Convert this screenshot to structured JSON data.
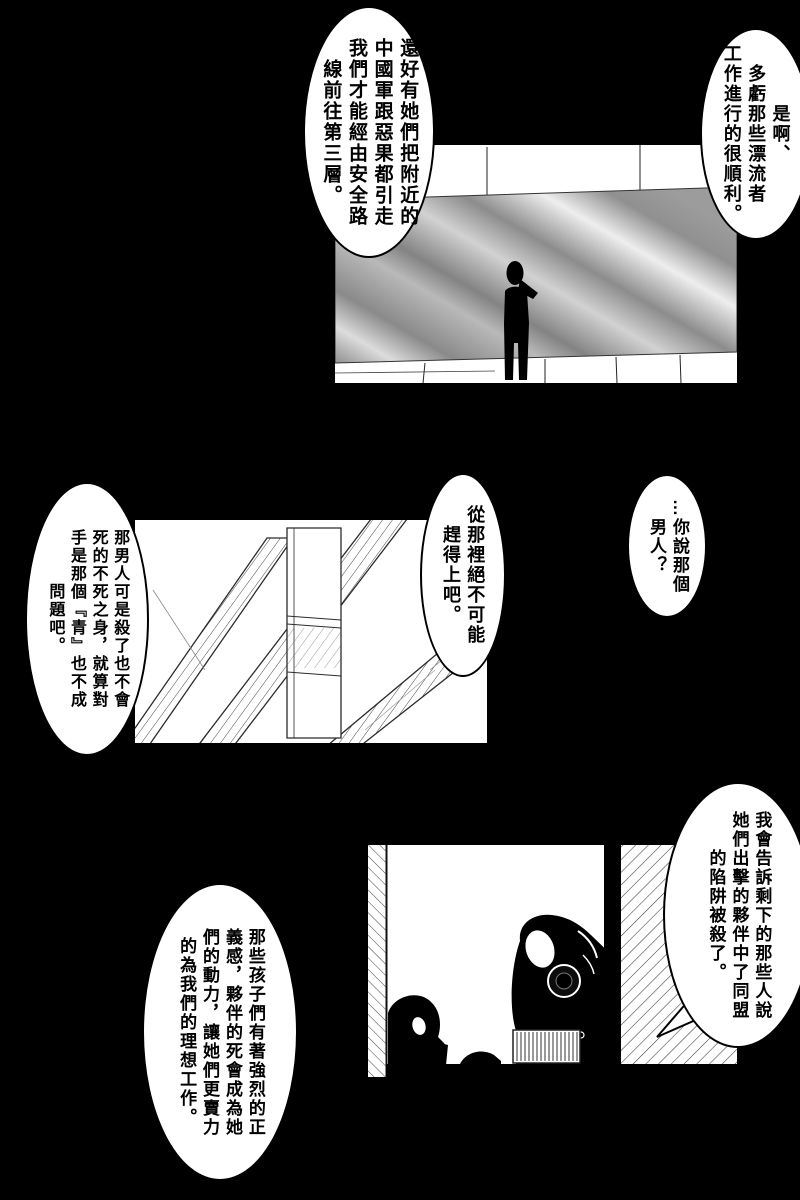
{
  "page": {
    "background_color": "#000000",
    "panel_color": "#ffffff",
    "ink_color": "#000000",
    "wall_gray": "#8f8f8f",
    "wall_highlight": "#ededed"
  },
  "bubbles": {
    "top_right": {
      "text": "是啊、\n多虧那些漂流者\n工作進行的很順利。"
    },
    "top_left": {
      "text": "還好有她們把附近的\n中國軍跟惡果都引走\n我們才能經由安全路\n線前往第三層。"
    },
    "mid_left": {
      "text": "那男人可是殺了也不會\n死的不死之身，就算對\n手是那個『青』也不成\n問題吧。"
    },
    "mid_center": {
      "text": "從那裡絕不可能\n趕得上吧。"
    },
    "mid_right": {
      "text": "…你說那個\n男人？"
    },
    "bottom_right": {
      "text": "我會告訴剩下的那些人說\n她們出擊的夥伴中了同盟\n的陷阱被殺了。"
    },
    "bottom_left": {
      "text": "那些孩子們有著強烈的正\n義感，夥伴的死會成為她\n們的動力，讓她們更賣力\n的為我們的理想工作。"
    }
  }
}
